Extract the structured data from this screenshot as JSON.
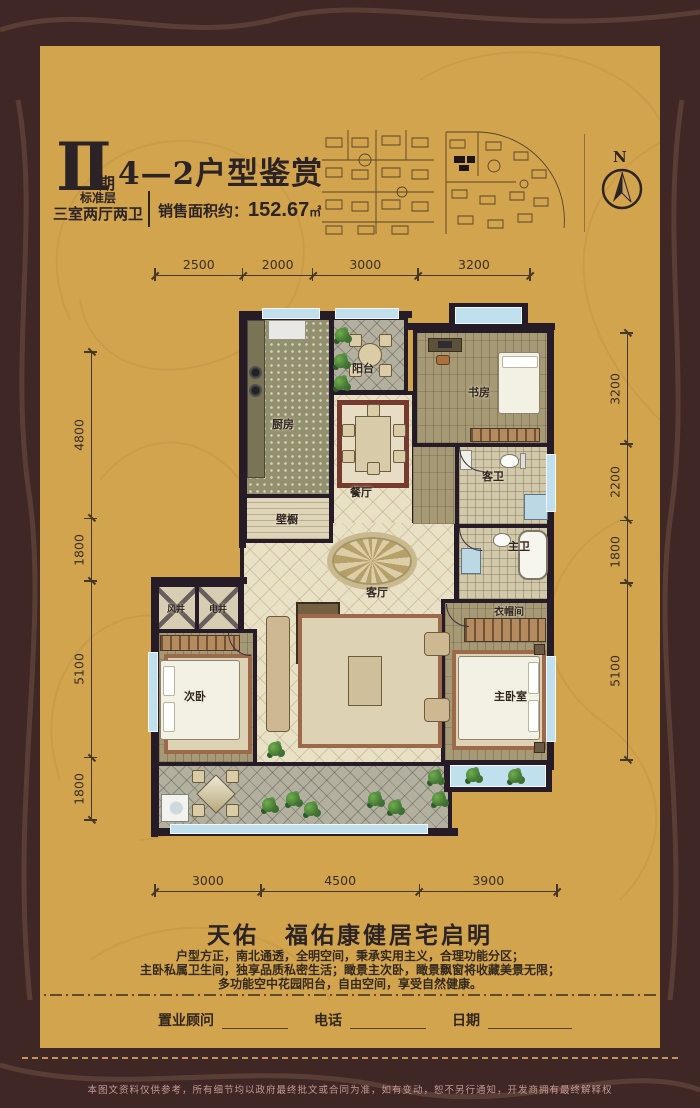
{
  "header": {
    "phase_numeral": "Ⅱ",
    "phase_suffix": "期",
    "title": "4—2户型鉴赏",
    "floor_label": "标准层",
    "layout_label": "三室两厅两卫",
    "area_label": "销售面积约：",
    "area_value": "152.67",
    "area_unit": "㎡",
    "compass_label": "N"
  },
  "dimensions": {
    "top": [
      "2500",
      "2000",
      "3000",
      "3200"
    ],
    "bottom": [
      "3000",
      "4500",
      "3900"
    ],
    "left": [
      "4800",
      "1800",
      "5100",
      "1800"
    ],
    "right": [
      "3200",
      "2200",
      "1800",
      "5100"
    ]
  },
  "rooms": {
    "balcony_top": "阳台",
    "study": "书房",
    "kitchen": "厨房",
    "dining": "餐厅",
    "guest_bath": "客卫",
    "closet": "壁橱",
    "master_bath": "主卫",
    "wind_shaft": "风井",
    "elec_shaft": "电井",
    "living": "客厅",
    "cloakroom": "衣帽间",
    "second_bedroom": "次卧",
    "master_bedroom": "主卧室"
  },
  "footer": {
    "slogan": "天佑　福佑康健居宅启明",
    "description_lines": [
      "户型方正，南北通透，全明空间，秉承实用主义，合理功能分区；",
      "主卧私属卫生间，独享品质私密生活；瞰景主次卧，瞰景飘窗将收藏美景无限；",
      "多功能空中花园阳台，自由空间，享受自然健康。"
    ],
    "consultant_label": "置业顾问",
    "phone_label": "电话",
    "date_label": "日期",
    "disclaimer": "本图文资料仅供参考，所有细节均以政府最终批文或合同为准，如有变动，恕不另行通知，开发商拥有最终解释权"
  },
  "colors": {
    "background": "#d3a44e",
    "frame": "#3e2725",
    "wall": "#261c27",
    "window_blue": "#bfe0ec",
    "accent_gold": "#c29555",
    "rug_red": "#76392f"
  }
}
